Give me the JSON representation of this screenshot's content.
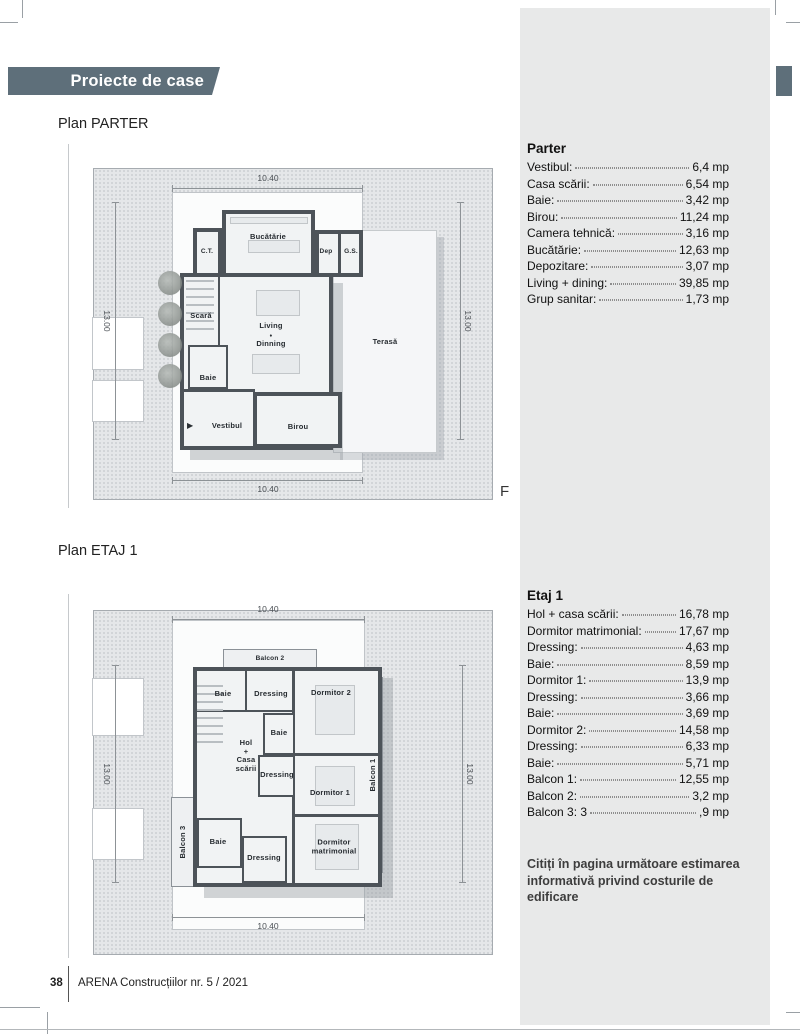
{
  "header": {
    "banner": "Proiecte de case"
  },
  "plans": {
    "parter": {
      "title": "Plan PARTER",
      "dims": {
        "width_top": "10.40",
        "width_bottom": "10.40",
        "height_left": "13.00",
        "height_right": "13.00"
      },
      "rooms": {
        "bucatarie": "Bucătărie",
        "ct": "C.T.",
        "dep": "Dep",
        "gs": "G.S.",
        "scara": "Scară",
        "living_line1": "Living",
        "living_sep": "♦",
        "living_line2": "Dinning",
        "baie": "Baie",
        "vestibul": "Vestibul",
        "birou": "Birou",
        "terasa": "Terasă"
      },
      "crop_letter": "F"
    },
    "etaj": {
      "title": "Plan ETAJ 1",
      "dims": {
        "width_top": "10.40",
        "width_bottom": "10.40",
        "height_left": "13.00",
        "height_right": "13.00"
      },
      "rooms": {
        "balcon2": "Balcon 2",
        "baie_top": "Baie",
        "dressing_top": "Dressing",
        "dormitor2": "Dormitor 2",
        "hol_line1": "Hol",
        "hol_sep": "+",
        "hol_line2": "Casa",
        "hol_line3": "scării",
        "baie_mid": "Baie",
        "dressing_mid": "Dressing",
        "dormitor1": "Dormitor 1",
        "balcon1": "Balcon 1",
        "balcon3": "Balcon 3",
        "baie_bottom": "Baie",
        "dressing_bottom": "Dressing",
        "dormitor_matrimonial_line1": "Dormitor",
        "dormitor_matrimonial_line2": "matrimonial"
      }
    }
  },
  "area_lists": {
    "parter": {
      "heading": "Parter",
      "items": [
        {
          "label": "Vestibul:",
          "value": "6,4 mp"
        },
        {
          "label": "Casa scării:",
          "value": "6,54 mp"
        },
        {
          "label": "Baie:",
          "value": "3,42 mp"
        },
        {
          "label": "Birou:",
          "value": "11,24 mp"
        },
        {
          "label": "Camera tehnică:",
          "value": "3,16 mp"
        },
        {
          "label": "Bucătărie:",
          "value": "12,63 mp"
        },
        {
          "label": "Depozitare:",
          "value": "3,07 mp"
        },
        {
          "label": "Living + dining:",
          "value": "39,85 mp"
        },
        {
          "label": "Grup sanitar:",
          "value": "1,73 mp"
        }
      ]
    },
    "etaj": {
      "heading": "Etaj 1",
      "items": [
        {
          "label": "Hol + casa scării:",
          "value": "16,78 mp"
        },
        {
          "label": "Dormitor matrimonial:",
          "value": "17,67 mp"
        },
        {
          "label": "Dressing:",
          "value": "4,63 mp"
        },
        {
          "label": "Baie:",
          "value": "8,59 mp"
        },
        {
          "label": "Dormitor 1:",
          "value": "13,9 mp"
        },
        {
          "label": "Dressing:",
          "value": "3,66 mp"
        },
        {
          "label": "Baie:",
          "value": "3,69 mp"
        },
        {
          "label": "Dormitor 2:",
          "value": "14,58 mp"
        },
        {
          "label": "Dressing:",
          "value": "6,33 mp"
        },
        {
          "label": "Baie:",
          "value": "5,71 mp"
        },
        {
          "label": "Balcon 1:",
          "value": "12,55 mp"
        },
        {
          "label": "Balcon 2:",
          "value": "3,2 mp"
        },
        {
          "label": "Balcon 3: 3",
          "value": ",9 mp"
        }
      ]
    }
  },
  "note": "Citiți în pagina următoare estimarea informativă privind costurile de edificare",
  "footer": {
    "page_number": "38",
    "magazine": "ARENA Construcțiilor nr. 5 / 2021"
  },
  "colors": {
    "accent": "#5e6f7a",
    "panel_bg": "#e8e9e9",
    "wall": "#4d5359"
  }
}
